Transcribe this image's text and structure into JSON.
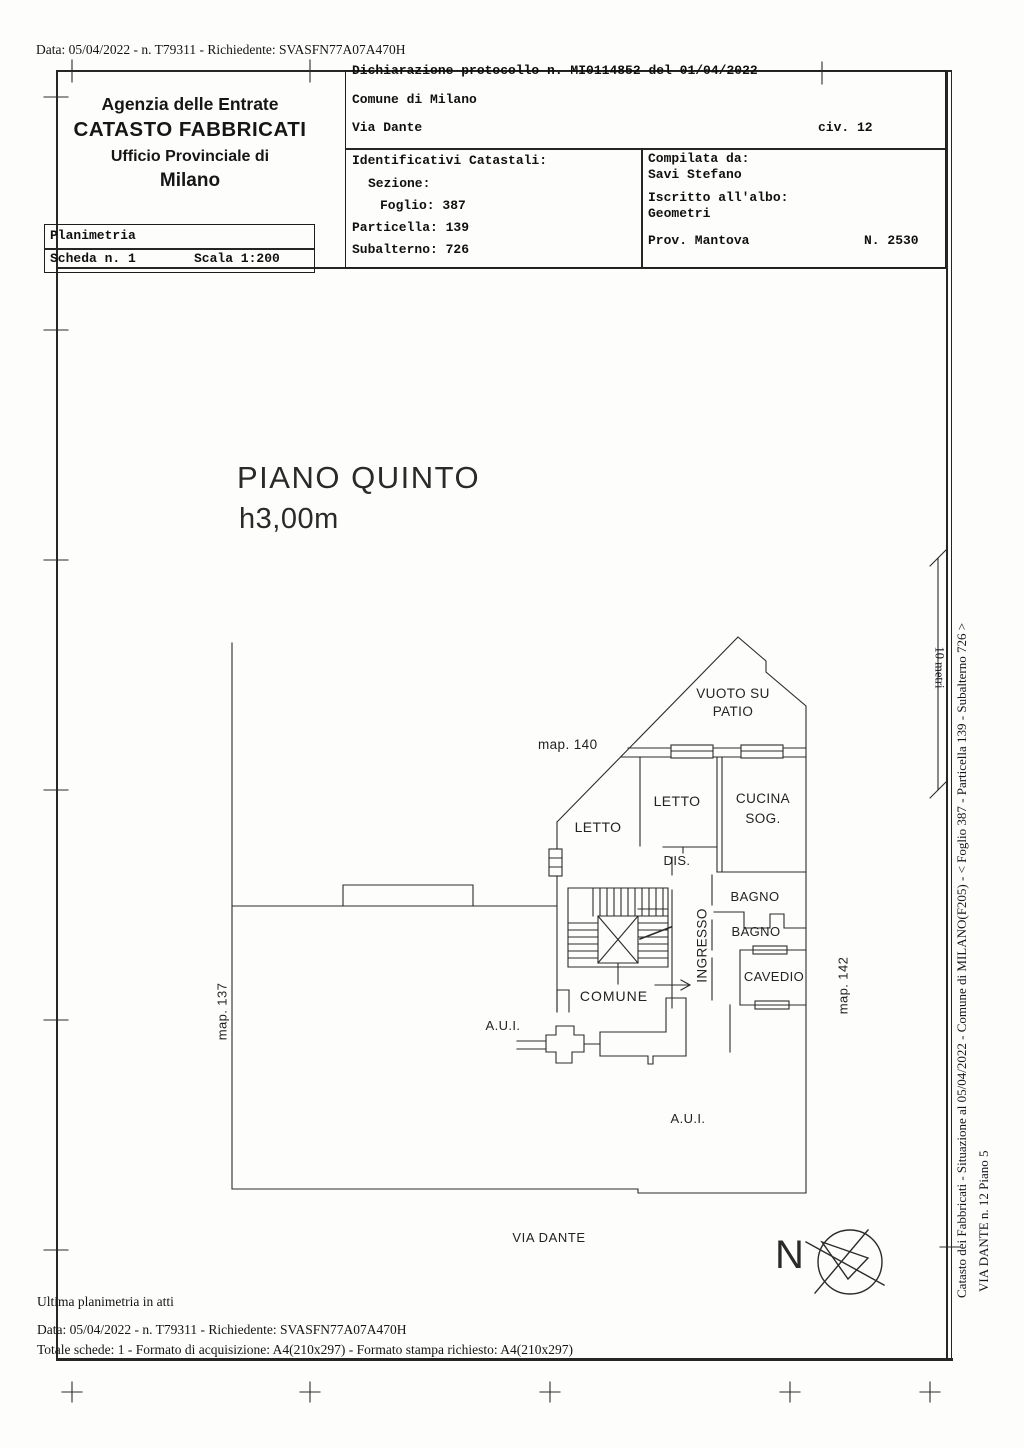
{
  "document": {
    "request_line": "Data: 05/04/2022 - n. T79311 - Richiedente: SVASFN77A07A470H",
    "agency": {
      "l1": "Agenzia delle Entrate",
      "l2": "CATASTO FABBRICATI",
      "l3": "Ufficio Provinciale di",
      "l4": "Milano"
    },
    "planimetria": {
      "title": "Planimetria",
      "scheda": "Scheda n. 1",
      "scala": "Scala 1:200"
    },
    "declaration": {
      "protocol": "Dichiarazione protocollo n. MI0114852 del 01/04/2022",
      "comune": "Comune di Milano",
      "street": "Via Dante",
      "civic": "civ. 12"
    },
    "identifiers": {
      "title": "Identificativi Catastali:",
      "sezione": "Sezione:",
      "foglio": "Foglio: 387",
      "particella": "Particella: 139",
      "subalterno": "Subalterno: 726"
    },
    "compiler": {
      "label": "Compilata da:",
      "name": "Savi Stefano",
      "albo_label": "Iscritto all'albo:",
      "albo": "Geometri",
      "prov": "Prov. Mantova",
      "reg_number": "N. 2530"
    }
  },
  "plan": {
    "floor": "PIANO QUINTO",
    "height": "h3,00m",
    "rooms": {
      "vuoto1": "VUOTO SU",
      "vuoto2": "PATIO",
      "letto_a": "LETTO",
      "letto_b": "LETTO",
      "cucina": "CUCINA",
      "sog": "SOG.",
      "dis": "DIS.",
      "bagno_a": "BAGNO",
      "bagno_b": "BAGNO",
      "cavedio": "CAVEDIO",
      "ingresso": "INGRESSO",
      "comune": "COMUNE",
      "aui_a": "A.U.I.",
      "aui_b": "A.U.I."
    },
    "maps": {
      "m137": "map. 137",
      "m140": "map. 140",
      "m142": "map. 142"
    },
    "street": "VIA DANTE",
    "north": "N",
    "scale_bar": "10 metri"
  },
  "margin": {
    "line1": "Catasto dei Fabbricati - Situazione al 05/04/2022 - Comune di MILANO(F205) - <  Foglio 387 - Particella  139 - Subalterno 726 >",
    "line2": "VIA DANTE n. 12 Piano 5"
  },
  "footer": {
    "line1": "Ultima planimetria in atti",
    "line2": "Data: 05/04/2022 - n. T79311 - Richiedente: SVASFN77A07A470H",
    "line3": "Totale schede: 1 - Formato di acquisizione: A4(210x297)  - Formato stampa richiesto: A4(210x297)"
  },
  "colors": {
    "ink": "#262626",
    "paper": "#fdfdfc"
  }
}
